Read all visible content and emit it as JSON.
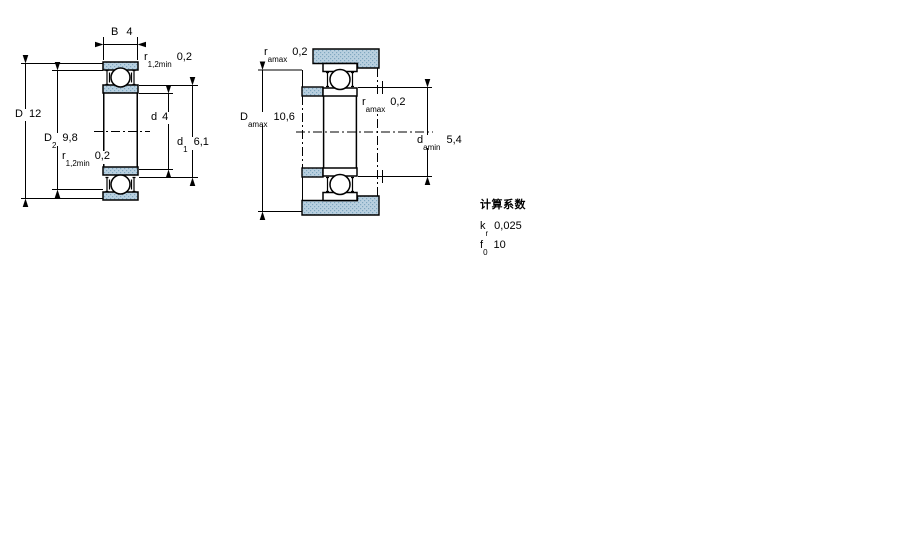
{
  "colors": {
    "hatch_fill": "#b9d0e0",
    "hatch_dot": "#7ea6bf",
    "line": "#000000"
  },
  "fig1": {
    "B": {
      "label": "B",
      "value": "4"
    },
    "r_top": {
      "base": "r",
      "sub": "1,2min",
      "value": "0,2"
    },
    "D": {
      "label": "D",
      "value": "12"
    },
    "D2": {
      "base": "D",
      "sub": "2",
      "value": "9,8"
    },
    "r_bottom": {
      "base": "r",
      "sub": "1,2min",
      "value": "0,2"
    },
    "d": {
      "label": "d",
      "value": "4"
    },
    "d1": {
      "base": "d",
      "sub": "1",
      "value": "6,1"
    }
  },
  "fig2": {
    "r_top": {
      "base": "r",
      "sub": "amax",
      "value": "0,2"
    },
    "Damax": {
      "base": "D",
      "sub": "amax",
      "value": "10,6"
    },
    "r_mid": {
      "base": "r",
      "sub": "amax",
      "value": "0,2"
    },
    "damin": {
      "base": "d",
      "sub": "amin",
      "value": "5,4"
    }
  },
  "factors": {
    "title": "计算系数",
    "rows": [
      {
        "base": "k",
        "sub": "r",
        "value": "0,025"
      },
      {
        "base": "f",
        "sub": "0",
        "value": "10"
      }
    ]
  }
}
